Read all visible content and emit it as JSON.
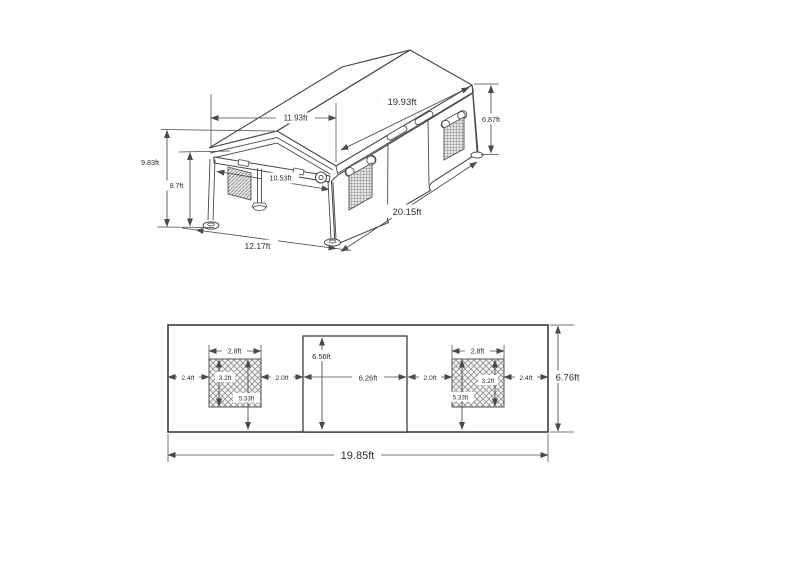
{
  "page": {
    "background": "#ffffff"
  },
  "isometric_view": {
    "labels": {
      "roof_front_width": "11.93ft",
      "roof_length": "19.93ft",
      "rear_side_height": "6.87ft",
      "peak_height": "9.83ft",
      "eave_height": "8.7ft",
      "front_opening_width": "10.53ft",
      "side_ground_length": "20.15ft",
      "front_ground_width": "12.17ft"
    }
  },
  "elevation_view": {
    "labels": {
      "overall_width": "19.85ft",
      "overall_height": "6.76ft",
      "door_width": "6.26ft",
      "door_height": "6.56ft",
      "window_width": "2.8ft",
      "window_height": "3.2ft",
      "window_top_to_ground": "5.33ft",
      "edge_to_window_gap": "2.4ft",
      "window_to_door_gap": "2.0ft"
    }
  }
}
